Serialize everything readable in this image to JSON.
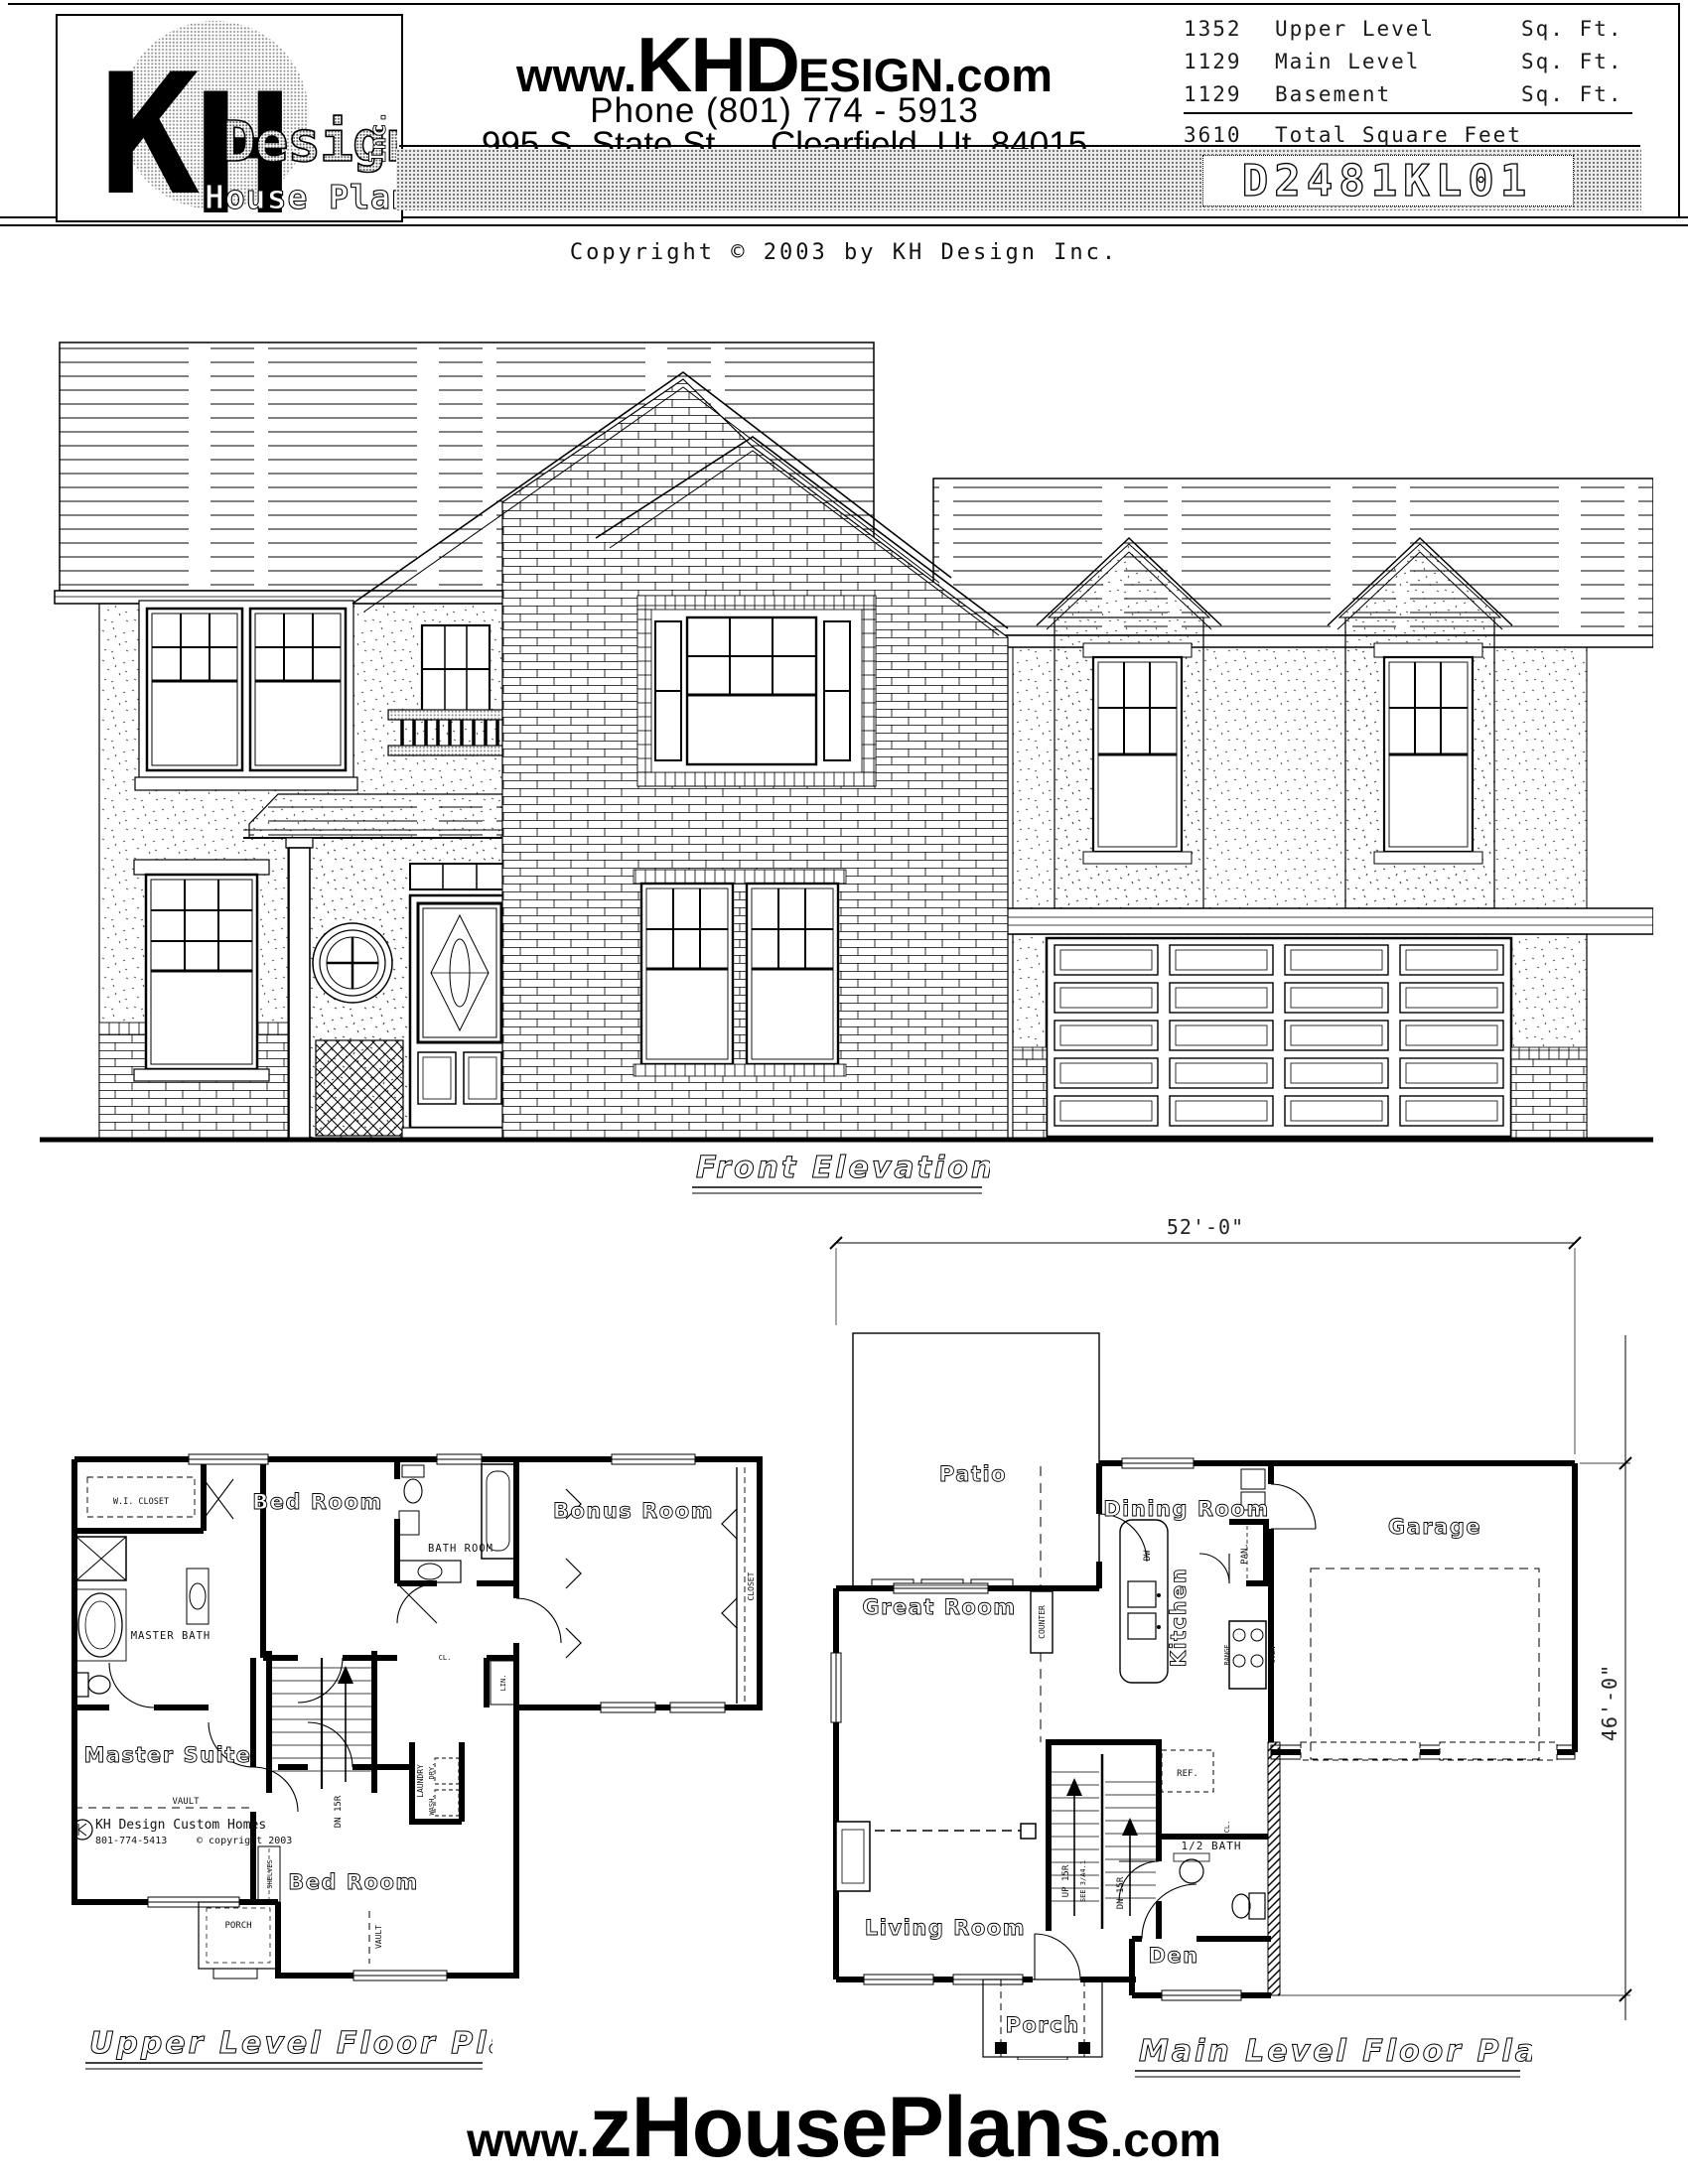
{
  "header": {
    "logo": {
      "kh": "KH",
      "design": "Design",
      "inc": "Inc.",
      "tagline": "House Plans"
    },
    "website": {
      "pre": "www.",
      "big": "KHD",
      "small": "ESIGN",
      "post": ".com"
    },
    "phone": "Phone (801) 774 - 5913",
    "address_1": "995 S. State St.",
    "address_2": "Clearfield, Ut. 84015",
    "sqft_rows": [
      {
        "value": "1352",
        "label": "Upper Level",
        "unit": "Sq. Ft."
      },
      {
        "value": "1129",
        "label": "Main Level",
        "unit": "Sq. Ft."
      },
      {
        "value": "1129",
        "label": "Basement",
        "unit": "Sq. Ft."
      }
    ],
    "total": {
      "value": "3610",
      "label": "Total Square Feet"
    },
    "plan_number": "D2481KL01"
  },
  "copyright": "Copyright © 2003 by KH Design Inc.",
  "elevation": {
    "caption": "Front Elevation"
  },
  "main_plan": {
    "caption": "Main Level Floor Plan",
    "dims": {
      "width": "52'-0\"",
      "height": "46'-0\""
    },
    "rooms": {
      "patio": "Patio",
      "dining": "Dining Room",
      "garage": "Garage",
      "great": "Great Room",
      "kitchen": "Kitchen",
      "living": "Living Room",
      "den": "Den",
      "porch": "Porch",
      "half_bath": "1/2 BATH"
    },
    "labels": {
      "counter": "COUNTER",
      "dw": "DW",
      "pan": "PAN.",
      "range": "RANGE",
      "oven": "OVEN",
      "ref": "REF.",
      "up": "UP 15R",
      "see": "SEE 3/A4.1",
      "dn": "DN 15R",
      "cl": "CL."
    }
  },
  "upper_plan": {
    "caption": "Upper Level Floor Plan",
    "rooms": {
      "bed_top": "Bed Room",
      "bonus": "Bonus Room",
      "bath": "BATH ROOM",
      "master_bath": "MASTER BATH",
      "master": "Master Suite",
      "bed_bottom": "Bed Room",
      "porch": "PORCH",
      "wi_closet": "W.I. CLOSET"
    },
    "labels": {
      "vault_master": "VAULT",
      "vault_bed": "VAULT",
      "closet": "CLOSET",
      "cl": "CL.",
      "lin": "LIN.",
      "shelves": "SHELVES",
      "laundry": "LAUNDRY",
      "dry": "DRY.",
      "wash": "WASH.",
      "dn": "DN 15R"
    },
    "stamp": {
      "name": "KH Design Custom Homes",
      "phone": "801-774-5413",
      "note": "© copyright 2003"
    }
  },
  "footer": {
    "pre": "www.",
    "big": "zHousePlans",
    "post": ".com"
  }
}
